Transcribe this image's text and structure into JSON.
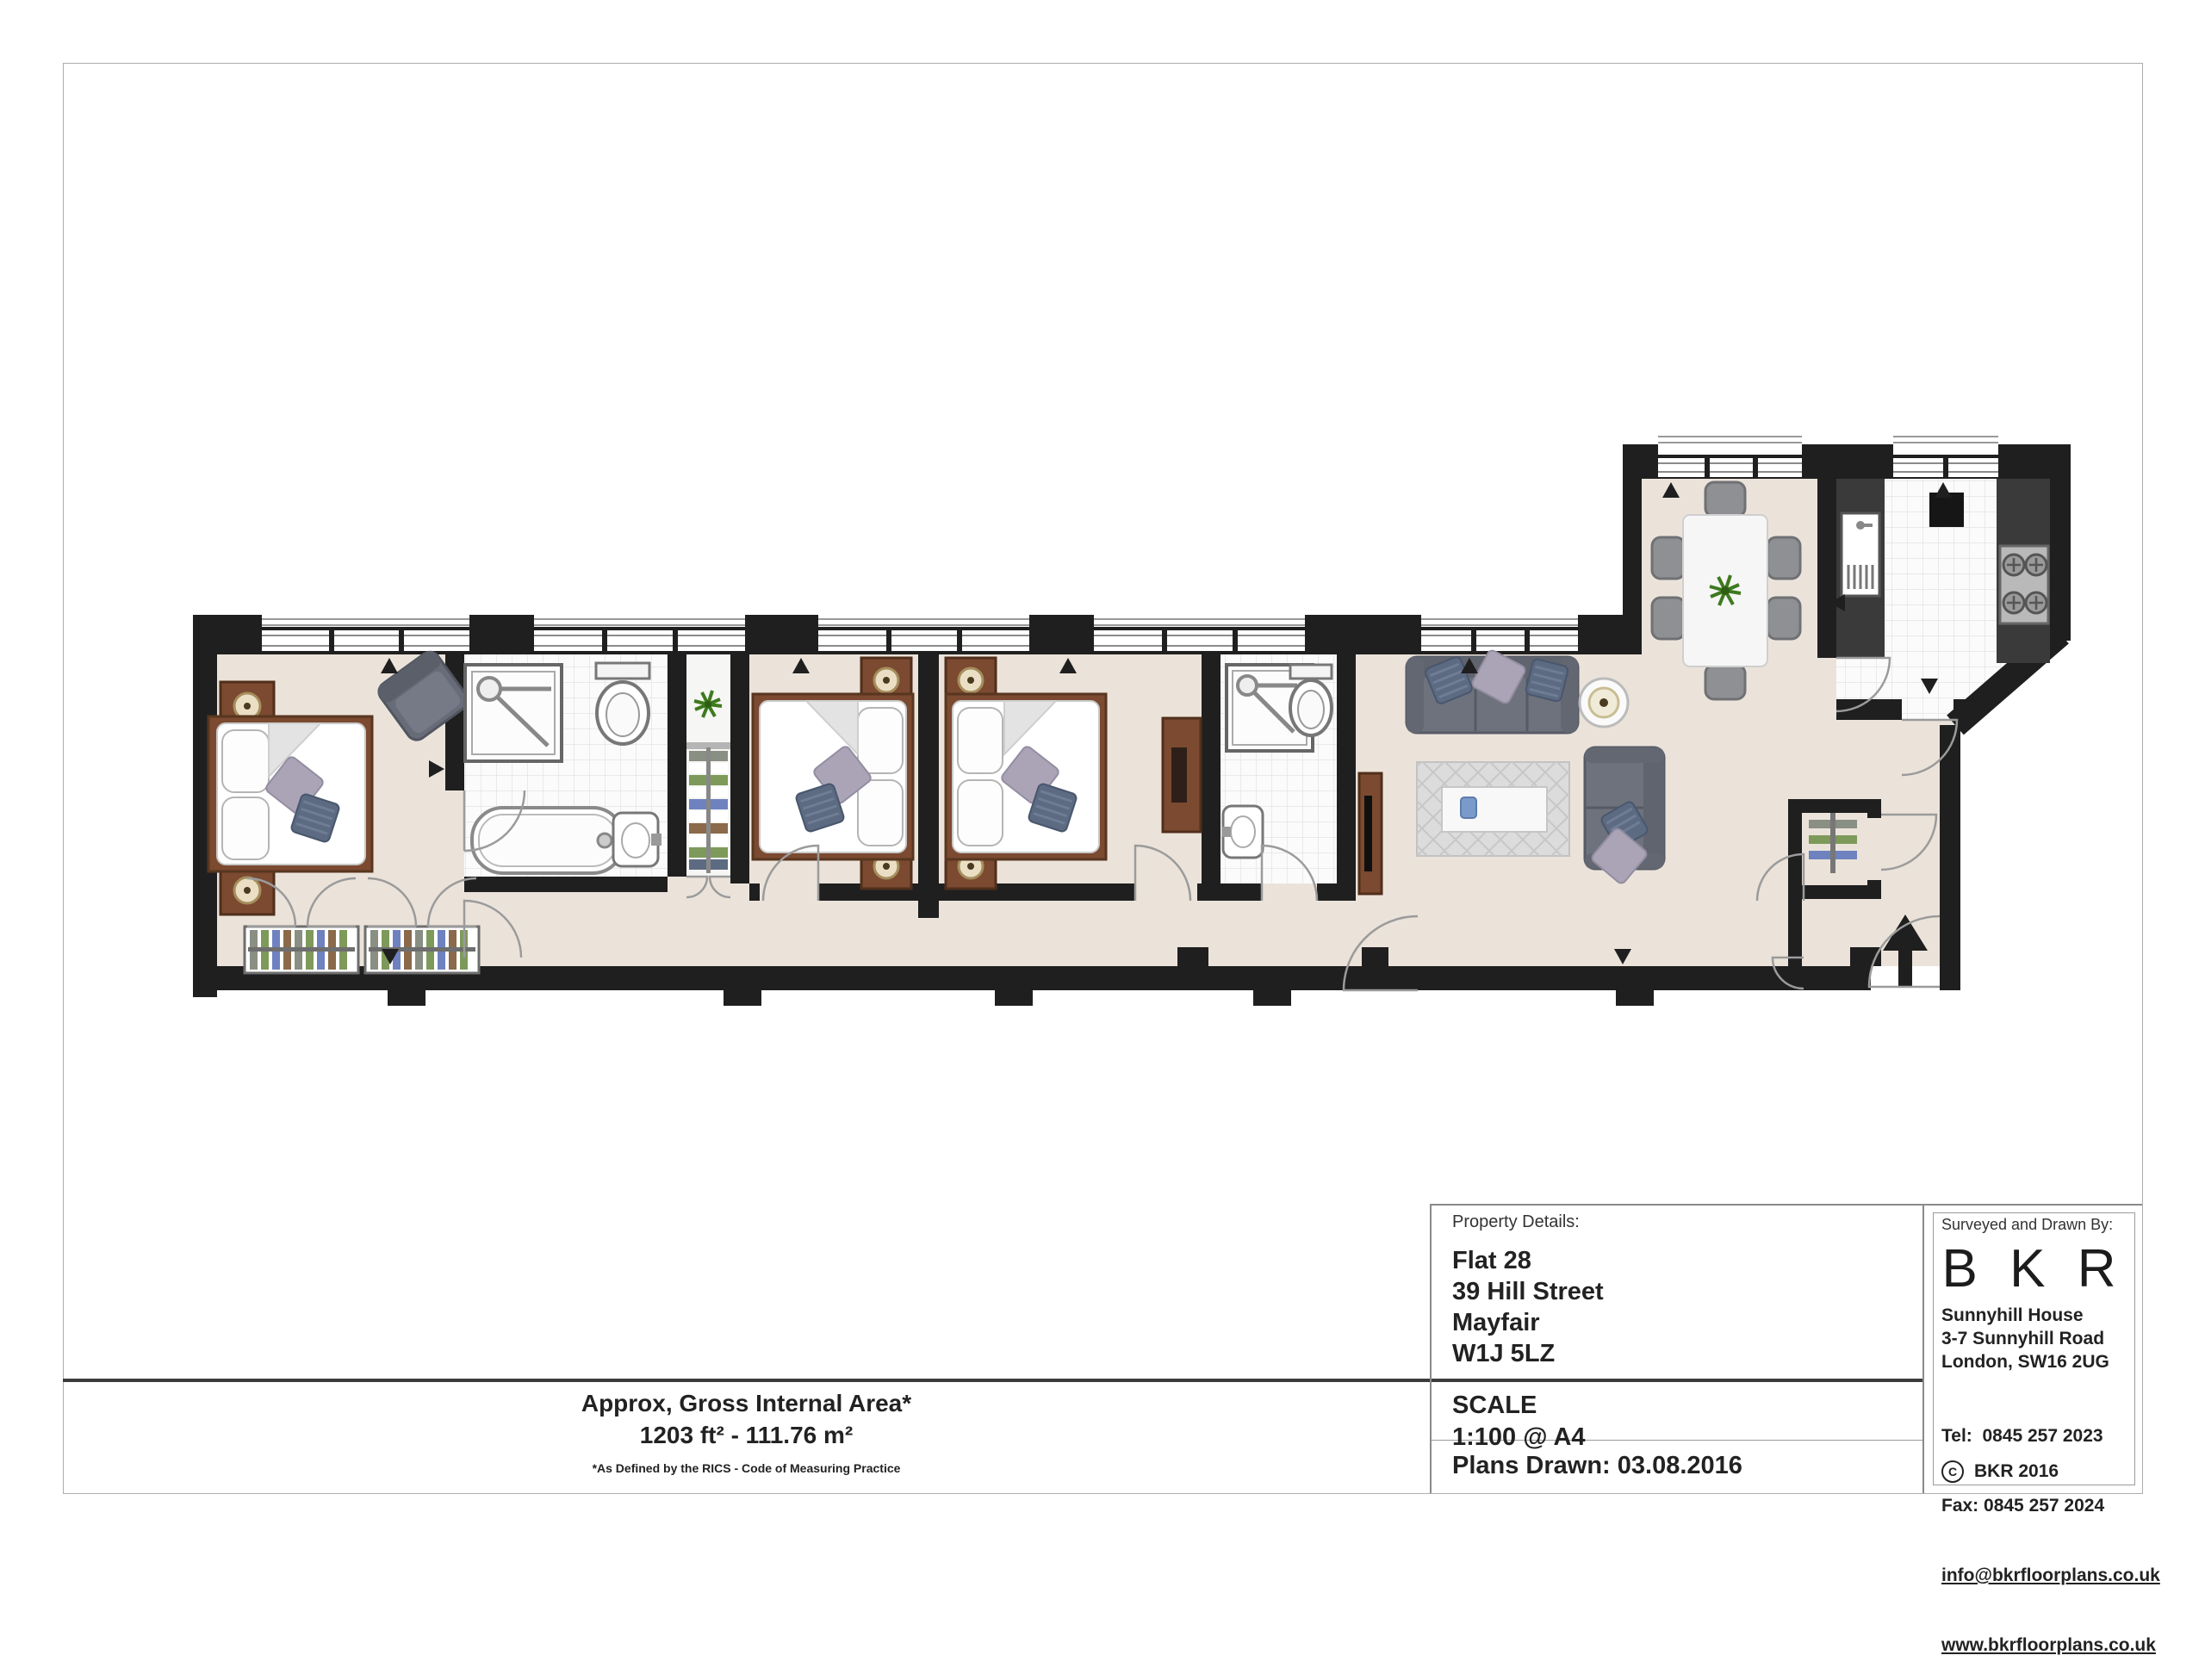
{
  "document": {
    "area_summary": {
      "title": "Approx, Gross Internal Area*",
      "value": "1203 ft² - 111.76 m²",
      "footnote": "*As Defined by the RICS - Code of Measuring Practice"
    },
    "property_details": {
      "label": "Property Details:",
      "line1": "Flat 28",
      "line2": "39 Hill Street",
      "line3": "Mayfair",
      "line4": "W1J 5LZ"
    },
    "scale": {
      "label": "SCALE",
      "value": "1:100 @ A4"
    },
    "plans_drawn": {
      "text": "Plans Drawn: 03.08.2016"
    },
    "surveyor": {
      "label": "Surveyed and Drawn By:",
      "logo": "B K R",
      "address1": "Sunnyhill House",
      "address2": "3-7 Sunnyhill Road",
      "address3": "London, SW16 2UG",
      "tel": "Tel:  0845 257 2023",
      "fax": "Fax: 0845 257 2024",
      "email": "info@bkrfloorplans.co.uk",
      "website": "www.bkrfloorplans.co.uk",
      "copyright_symbol": "C",
      "copyright": "BKR 2016"
    }
  },
  "colors": {
    "wall": "#1F1F1F",
    "floor_beige": "#EBE3DA",
    "tile_white": "#FBFBFB",
    "wood_brown": "#7B4A30",
    "sofa_gray": "#6E727D",
    "counter_dark": "#3A3A3A",
    "plant_green": "#3E7A1E",
    "rug_gray": "#DCDCDC",
    "accent_blue": "#6F82C0",
    "accent_green": "#7E9A5A"
  }
}
